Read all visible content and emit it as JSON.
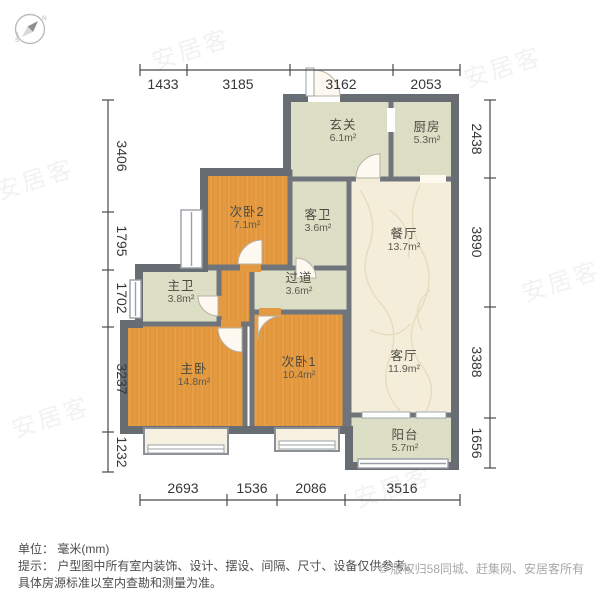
{
  "compass": {
    "north_label": "N",
    "south_label": "S"
  },
  "watermark": {
    "text": "安居客"
  },
  "rooms": [
    {
      "name": "玄关",
      "area": "6.1m²"
    },
    {
      "name": "厨房",
      "area": "5.3m²"
    },
    {
      "name": "次卧2",
      "area": "7.1m²"
    },
    {
      "name": "客卫",
      "area": "3.6m²"
    },
    {
      "name": "餐厅",
      "area": "13.7m²"
    },
    {
      "name": "主卫",
      "area": "3.8m²"
    },
    {
      "name": "过道",
      "area": "3.6m²"
    },
    {
      "name": "主卧",
      "area": "14.8m²"
    },
    {
      "name": "次卧1",
      "area": "10.4m²"
    },
    {
      "name": "客厅",
      "area": "11.9m²"
    },
    {
      "name": "阳台",
      "area": "5.7m²"
    }
  ],
  "dimensions": {
    "unit": "mm",
    "top": [
      "1433",
      "3185",
      "3162",
      "2053"
    ],
    "left": [
      "3406",
      "1795",
      "1702",
      "3237",
      "1232"
    ],
    "right": [
      "2438",
      "3890",
      "3388",
      "1656"
    ],
    "bottom": [
      "2693",
      "1536",
      "2086",
      "3516"
    ]
  },
  "footer": {
    "unit_line": "单位： 毫米(mm)",
    "tip_line1": "提示： 户型图中所有室内装饰、设计、摆设、间隔、尺寸、设备仅供参考。",
    "tip_line2": "具体房源标准以室内查勘和测量为准。",
    "copyright": "© 版权归58同城、赶集网、安居客所有"
  },
  "colors": {
    "wall": "#70757c",
    "floor_bedroom": "#e49a41",
    "floor_service": "#dcdfc6",
    "floor_living": "#f4edda",
    "bay_window_fill": "#f7f1e2",
    "window_stroke": "#9aa0a6",
    "dimension_text": "#35373a",
    "copyright_text": "#a8a8a8"
  }
}
